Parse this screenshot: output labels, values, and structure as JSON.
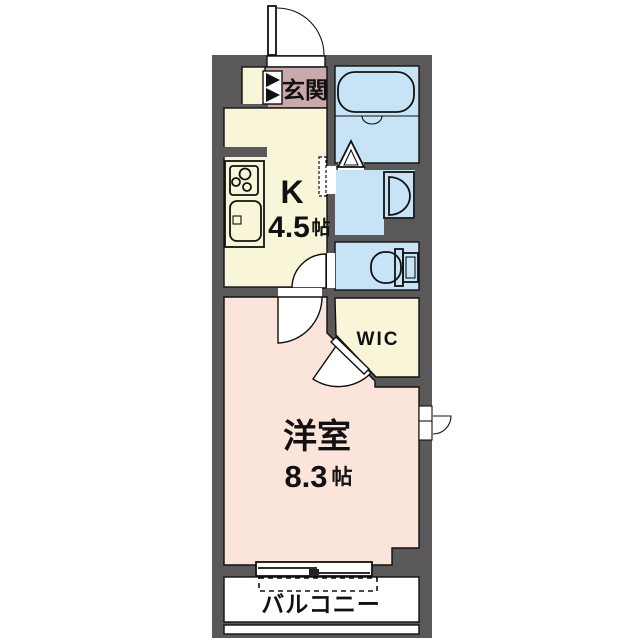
{
  "rooms": {
    "entrance": {
      "label": "玄関"
    },
    "kitchen": {
      "label": "K",
      "size_value": "4.5",
      "size_unit": "帖"
    },
    "wic": {
      "label": "WIC"
    },
    "living": {
      "label": "洋室",
      "size_value": "8.3",
      "size_unit": "帖"
    },
    "balcony": {
      "label": "バルコニー"
    }
  },
  "colors": {
    "wall": "#5a5858",
    "kitchen_yellow": "#f8f5d9",
    "entrance_mauve": "#c9a9ab",
    "water_blue": "#c7e4f6",
    "room_pink": "#fbe5da",
    "white": "#ffffff",
    "line": "#111111",
    "tick": "#222222"
  }
}
